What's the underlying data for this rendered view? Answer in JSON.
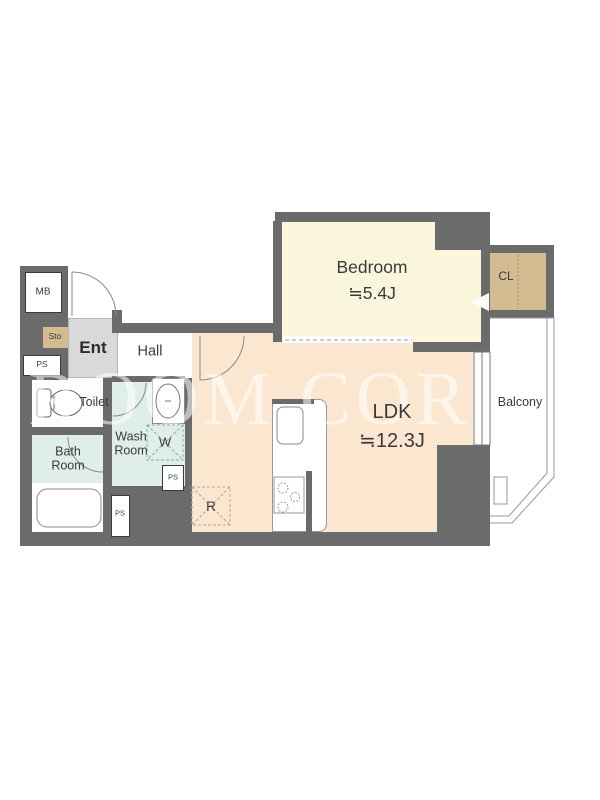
{
  "floor_plan": {
    "watermark": "ROOM COR",
    "rooms": {
      "bedroom": {
        "name": "Bedroom",
        "size": "≒5.4J"
      },
      "ldk": {
        "name": "LDK",
        "size": "≒12.3J"
      },
      "balcony": {
        "name": "Balcony"
      },
      "closet": {
        "name": "CL"
      },
      "entrance": {
        "name": "Ent"
      },
      "hall": {
        "name": "Hall"
      },
      "toilet": {
        "name": "Toilet"
      },
      "washroom": {
        "line1": "Wash",
        "line2": "Room"
      },
      "bathroom": {
        "line1": "Bath",
        "line2": "Room"
      }
    },
    "fixtures": {
      "meter_box": "MB",
      "storage": "Sto",
      "pipe_shaft": "PS",
      "washing_machine": "W",
      "refrigerator": "R"
    },
    "colors": {
      "wall": "#6b6b6b",
      "bedroom_floor": "#f9f6dc",
      "ldk_floor": "#fbe6d0",
      "wet_area_floor": "#e0eeea",
      "entrance_floor": "#d9d9d9",
      "storage_fill": "#d5bb92",
      "label_text": "#3a3a3a"
    }
  }
}
